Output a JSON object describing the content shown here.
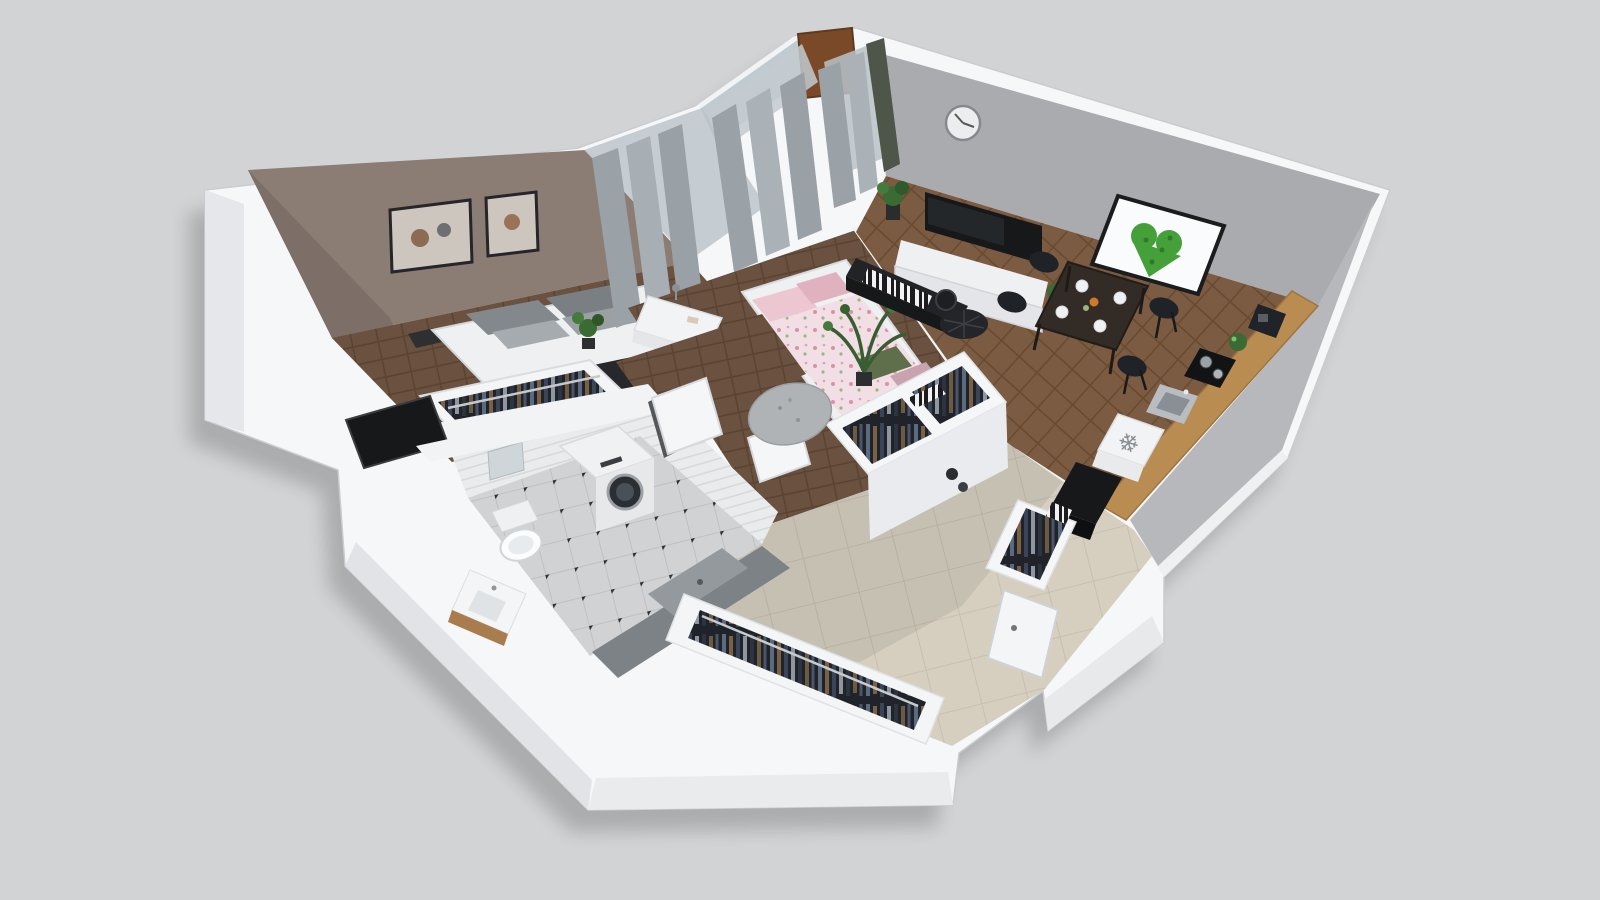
{
  "meta": {
    "title": "3D isometric apartment floor plan render",
    "view": "cutaway top-down isometric",
    "background": "plain light gray backdrop, no text or UI chrome"
  },
  "palette": {
    "background": "#d2d3d5",
    "wall_white": "#f6f7f8",
    "wall_band": "#f2f3f5",
    "wall_taupe": "#8b7c74",
    "wall_taupe_dark": "#7d6f68",
    "wall_gray": "#a9abaf",
    "wall_gray_light": "#b6b8bc",
    "partition_gray": "#8e9094",
    "accent_green_wall": "#4e564a",
    "heart_green": "#45a03a",
    "heart_green_dark": "#2f7a28",
    "wood_dark": "#6a5140",
    "wood_living": "#7b5b41",
    "tile_beige": "#d6cfc0",
    "tile_bath": "#d0d2d4",
    "tile_wall": "#e9ebed",
    "counter_wood": "#b98d52",
    "vanity_wood": "#a97c4e",
    "black": "#17181a",
    "dark_gray": "#26282b",
    "curtain_gray": "#9aa1a7",
    "glass": "#b9c2c8",
    "door_brown": "#7a4a28",
    "bed_white": "#eef0f2",
    "pink_duvet": "#f2dfe5",
    "pink_pillow": "#e0b2c0",
    "green_pillow": "#5f6f4c",
    "plant_green": "#3b6a33",
    "clothes_bg": "#20242a",
    "appliance_gray": "#8a9096",
    "shadow": "#000000"
  },
  "icons": {
    "snowflake": "❄"
  },
  "scene": {
    "rooms": [
      {
        "id": "bedroom",
        "label": "Bedroom",
        "items": [
          "double bed with gray pillows and black runner",
          "two framed wall prints",
          "bedside table",
          "open wardrobe rail with clothes",
          "potted plant",
          "curtained window"
        ]
      },
      {
        "id": "kids-room",
        "label": "Second bedroom",
        "items": [
          "white day bed with pink floral duvet",
          "desk with lamp",
          "white chair",
          "round gray rug",
          "palm plant",
          "floor-to-ceiling curtains",
          "balcony windows"
        ]
      },
      {
        "id": "living-room",
        "label": "Living room",
        "items": [
          "wall clock",
          "wall-mounted TV",
          "white media cabinet",
          "potted plants",
          "black round pouf",
          "black console with books",
          "dining table with four black chairs",
          "moss heart wall art",
          "balcony door with curtain"
        ]
      },
      {
        "id": "kitchen",
        "label": "Kitchen corner",
        "items": [
          "coffee machine",
          "herb bowl",
          "black cooktop with pots",
          "stainless sink",
          "fridge marked with snowflake symbol",
          "black tall unit"
        ]
      },
      {
        "id": "bathroom",
        "label": "Bathroom",
        "items": [
          "washing machine",
          "wall-hung toilet",
          "mirror",
          "vanity with sink",
          "dark shower enclosure",
          "diamond-dot tile floor",
          "black service shaft"
        ]
      },
      {
        "id": "hallway",
        "label": "Hallway / entry",
        "items": [
          "beige tile floor",
          "open wardrobes full of hanging clothes",
          "white shelf boxes with books",
          "entry door ajar",
          "interior doors",
          "round door rug",
          "decorative vases"
        ]
      }
    ]
  }
}
